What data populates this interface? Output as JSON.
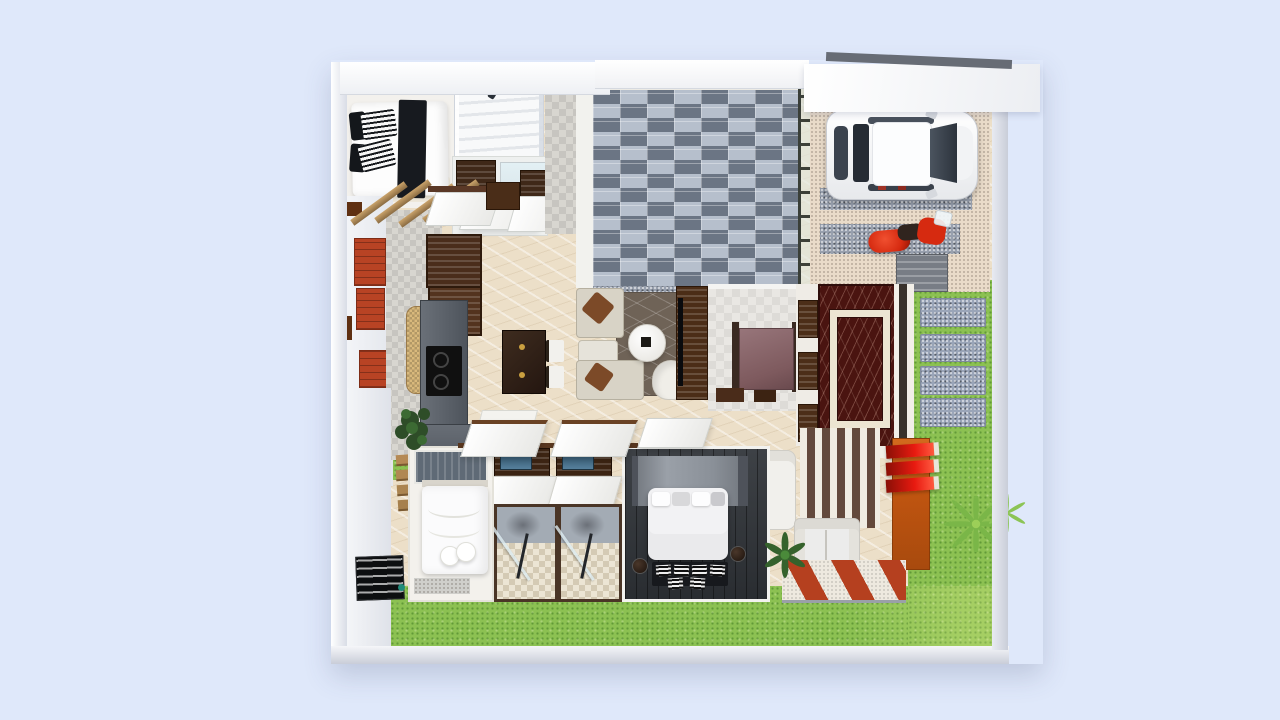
{
  "scene": {
    "title": "3d-rendered-house-floor-plan-top-view",
    "palette": {
      "bg": "#dfe8fa",
      "wallWhite": "#f4f5f8",
      "creamFloor": "#ecdfc8",
      "grass": "#8cc152",
      "brickDark": "#6b7584",
      "brickLight": "#b6bfcc",
      "driveBeige": "#e9dbc9",
      "gravel": "#98a0ae",
      "accentBrickRed": "#b84324",
      "darkWood": "#3c2413",
      "midWood": "#5a3826",
      "counterGray": "#5d646d",
      "rugBrown": "#6f6357",
      "sofaCream": "#d8d3c6",
      "marbleRed": "#4a1410",
      "orange": "#c05510",
      "finRed": "#e81a10",
      "floorDark": "#33373c",
      "carWhite": "#f4f5f7",
      "scooterRed": "#d62a10",
      "tileGray": "#d8d6d0",
      "mosaic": "#a3abb4",
      "stripeDark": "#63493c",
      "pathBrick": "#b5401f"
    },
    "rooms": [
      "bedroom-1",
      "staircase",
      "bathroom-top",
      "brick-courtyard",
      "carport",
      "side-passage",
      "kitchen",
      "dining-area",
      "living-room",
      "foyer",
      "entrance-porch",
      "bedroom-2",
      "shower-room-1",
      "shower-room-2",
      "master-bedroom",
      "terrace-lounge",
      "garden-lawn"
    ],
    "objects": [
      "double-bed",
      "single-bed",
      "master-bed",
      "white-car",
      "red-scooter",
      "dining-table",
      "l-shaped-sofa",
      "round-coffee-table",
      "armchair",
      "tv-console",
      "wardrobe",
      "shower-stall",
      "outdoor-sofa",
      "potted-plants",
      "stepping-pavers",
      "orange-feature-wall",
      "red-louver-fins",
      "brick-accent-panels",
      "wood-pergola",
      "doormat"
    ]
  }
}
